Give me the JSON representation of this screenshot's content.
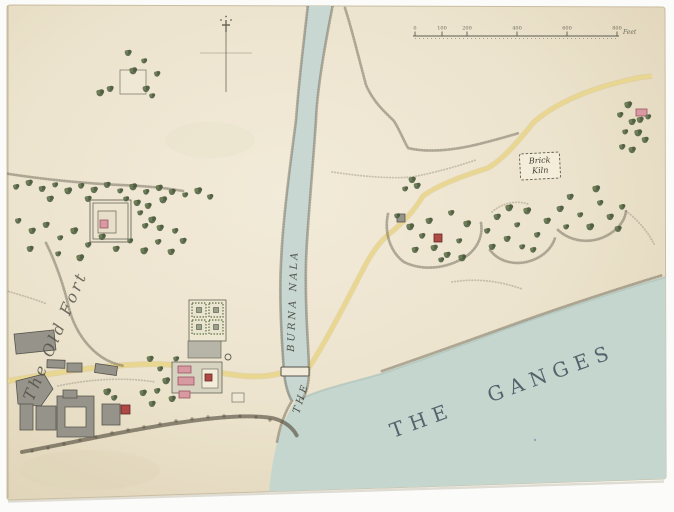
{
  "labels": {
    "ganges": "THE GANGES",
    "nala_article": "THE",
    "nala_name": "BURNA NALA",
    "old_fort": "The Old Fort",
    "brick_kiln_1": "Brick",
    "brick_kiln_2": "Kiln",
    "scale_unit": "Feet",
    "scale_ticks": [
      "0",
      "100",
      "200",
      "400",
      "600",
      "800"
    ],
    "scale_tick_x": [
      415,
      442,
      467,
      517,
      567,
      617
    ]
  },
  "colors": {
    "paper": "#eee6d2",
    "paper_edge": "#ddd1b5",
    "water": "#c5d6cf",
    "road": "#e9d78e",
    "road_edge": "#d9c276",
    "tree": "#556648",
    "tree_dark": "#46563a",
    "tree_light": "#66764e",
    "ink": "#4b4b42",
    "building_gray": "#96938a",
    "building_pink": "#d79aa2",
    "building_pink_edge": "#9c5560",
    "building_red": "#b04844",
    "building_red_edge": "#5d2a28"
  },
  "features": {
    "trees": [
      [
        128,
        53
      ],
      [
        144,
        61
      ],
      [
        133,
        71
      ],
      [
        157,
        74
      ],
      [
        146,
        89
      ],
      [
        110,
        89
      ],
      [
        152,
        96
      ],
      [
        100,
        93
      ],
      [
        16,
        187
      ],
      [
        29,
        183
      ],
      [
        42,
        189
      ],
      [
        55,
        185
      ],
      [
        68,
        191
      ],
      [
        81,
        186
      ],
      [
        94,
        190
      ],
      [
        107,
        185
      ],
      [
        120,
        191
      ],
      [
        133,
        187
      ],
      [
        146,
        192
      ],
      [
        159,
        188
      ],
      [
        172,
        192
      ],
      [
        185,
        195
      ],
      [
        198,
        191
      ],
      [
        210,
        197
      ],
      [
        50,
        199
      ],
      [
        88,
        199
      ],
      [
        126,
        199
      ],
      [
        163,
        200
      ],
      [
        18,
        221
      ],
      [
        32,
        231
      ],
      [
        46,
        225
      ],
      [
        60,
        238
      ],
      [
        74,
        231
      ],
      [
        88,
        245
      ],
      [
        102,
        237
      ],
      [
        116,
        249
      ],
      [
        130,
        241
      ],
      [
        144,
        251
      ],
      [
        158,
        242
      ],
      [
        171,
        252
      ],
      [
        30,
        249
      ],
      [
        58,
        254
      ],
      [
        80,
        258
      ],
      [
        145,
        226
      ],
      [
        160,
        228
      ],
      [
        183,
        241
      ],
      [
        140,
        213
      ],
      [
        152,
        220
      ],
      [
        175,
        231
      ],
      [
        137,
        203
      ],
      [
        148,
        206
      ],
      [
        160,
        369
      ],
      [
        166,
        381
      ],
      [
        157,
        391
      ],
      [
        172,
        399
      ],
      [
        150,
        359
      ],
      [
        176,
        359
      ],
      [
        107,
        392
      ],
      [
        114,
        398
      ],
      [
        143,
        393
      ],
      [
        152,
        404
      ],
      [
        397,
        216
      ],
      [
        410,
        227
      ],
      [
        422,
        236
      ],
      [
        434,
        248
      ],
      [
        447,
        255
      ],
      [
        459,
        241
      ],
      [
        467,
        224
      ],
      [
        451,
        213
      ],
      [
        429,
        221
      ],
      [
        415,
        250
      ],
      [
        441,
        260
      ],
      [
        462,
        258
      ],
      [
        487,
        231
      ],
      [
        497,
        217
      ],
      [
        507,
        239
      ],
      [
        517,
        225
      ],
      [
        527,
        211
      ],
      [
        537,
        235
      ],
      [
        547,
        221
      ],
      [
        492,
        247
      ],
      [
        522,
        247
      ],
      [
        509,
        208
      ],
      [
        533,
        250
      ],
      [
        560,
        209
      ],
      [
        570,
        197
      ],
      [
        580,
        215
      ],
      [
        590,
        227
      ],
      [
        600,
        203
      ],
      [
        610,
        217
      ],
      [
        618,
        229
      ],
      [
        566,
        227
      ],
      [
        596,
        189
      ],
      [
        622,
        207
      ],
      [
        412,
        180
      ],
      [
        417,
        186
      ],
      [
        405,
        189
      ],
      [
        628,
        105
      ],
      [
        620,
        115
      ],
      [
        632,
        122
      ],
      [
        640,
        120
      ],
      [
        625,
        132
      ],
      [
        638,
        133
      ],
      [
        622,
        147
      ],
      [
        632,
        150
      ],
      [
        645,
        140
      ],
      [
        648,
        117
      ]
    ],
    "shrubs": [
      [
        32,
        451
      ],
      [
        48,
        448
      ],
      [
        64,
        444
      ],
      [
        80,
        440
      ],
      [
        96,
        437
      ],
      [
        112,
        433
      ],
      [
        128,
        430
      ],
      [
        144,
        427
      ],
      [
        160,
        424
      ],
      [
        176,
        421
      ],
      [
        192,
        419
      ],
      [
        208,
        417
      ],
      [
        224,
        416
      ],
      [
        240,
        416
      ],
      [
        256,
        417
      ],
      [
        270,
        420
      ]
    ],
    "gray_buildings": [
      [
        15,
        332,
        40,
        20,
        -6
      ],
      [
        47,
        360,
        18,
        8,
        2
      ],
      [
        67,
        363,
        15,
        9,
        0
      ],
      [
        95,
        365,
        22,
        9,
        8
      ],
      [
        20,
        404,
        13,
        26,
        0
      ],
      [
        36,
        406,
        20,
        24,
        0
      ],
      [
        102,
        404,
        18,
        21,
        0
      ],
      [
        63,
        390,
        14,
        8,
        0
      ],
      [
        397,
        214,
        8,
        8,
        0
      ]
    ],
    "pink_buildings": [
      [
        178,
        366,
        13,
        7
      ],
      [
        178,
        377,
        16,
        8
      ],
      [
        179,
        391,
        11,
        7
      ],
      [
        100,
        220,
        8,
        8
      ],
      [
        636,
        109,
        11,
        7
      ]
    ],
    "red_squares": [
      [
        205,
        374,
        7
      ],
      [
        121,
        405,
        9
      ],
      [
        434,
        234,
        8
      ]
    ],
    "outline_buildings": [
      [
        120,
        70,
        26,
        24
      ],
      [
        232,
        393,
        12,
        9
      ]
    ],
    "garden_plots": [
      [
        192,
        303
      ],
      [
        209,
        303
      ],
      [
        192,
        320
      ],
      [
        209,
        320
      ]
    ],
    "wells": [
      [
        228,
        357
      ]
    ]
  }
}
